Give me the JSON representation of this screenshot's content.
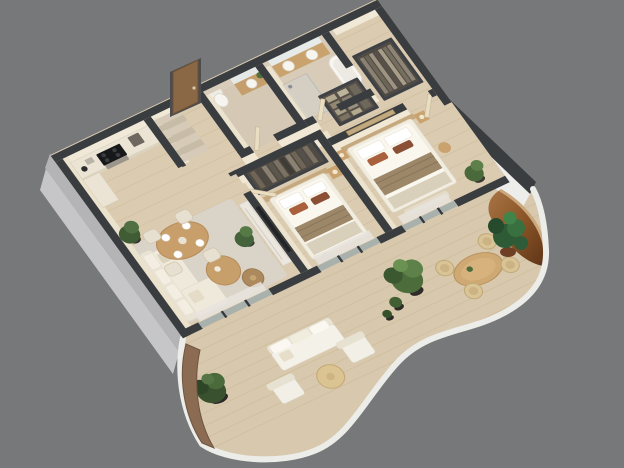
{
  "meta": {
    "description": "Photorealistic 3D isometric cutaway floor-plan render of a furnished one-level apartment, viewed from above at a rotated angle, on a plain gray studio background",
    "view": "axonometric dollhouse cutaway, walls sliced flat with dark tops",
    "no_visible_text": true
  },
  "colors": {
    "background": "#77787a",
    "wall_top": "#3a3d40",
    "exterior_wall": "#c6c6c8",
    "interior_wall": "#f0e9d7",
    "interior_wall_shade": "#ece3cf",
    "floor_wood": "#dbcbb0",
    "plank_line": "#c9b693",
    "tile": "#d5c8b4",
    "rug": "#dad3c7",
    "wood_furniture": "#c89f6a",
    "cream_fabric": "#efe9db",
    "bedding": "#faf7ef",
    "bed_runner": "#9d8769",
    "accent_pillow": "#a9613d",
    "wardrobe_frame": "#3e4145",
    "foliage": "#4c6c3b",
    "foliage_dark": "#2f4b2a",
    "balcony_floor": "#d8c9ae",
    "balcony_rim": "#ecece9",
    "copper_wall": "#9c6840",
    "planter_bronze": "#8b6c52",
    "glass": "#cfd8d6",
    "curtain": "#e7e4de",
    "door_wood": "#8a6845",
    "marble_console": "#ebe7df"
  },
  "apartment": {
    "rooms": [
      {
        "name": "kitchen",
        "position": "top-left corner",
        "furniture": [
          "straight counter with black cooktop and oven under",
          "side counter return with kettle and small appliances",
          "coffee machine"
        ]
      },
      {
        "name": "staircase",
        "position": "beside kitchen",
        "furniture": [
          "narrow stair run with seven treads"
        ]
      },
      {
        "name": "hallway",
        "position": "center-left",
        "furniture": [
          "wood entry door on the upper exterior wall"
        ]
      },
      {
        "name": "guest-bathroom",
        "position": "top-center",
        "furniture": [
          "toilet",
          "wood vanity with round basin",
          "lit mirror",
          "small plant"
        ]
      },
      {
        "name": "master-bathroom",
        "position": "top-right",
        "furniture": [
          "double wood vanity with two round basins",
          "wide lit mirror",
          "freestanding bathtub",
          "glass walk-in shower",
          "travertine tiled walls"
        ]
      },
      {
        "name": "walk-in-closet",
        "position": "right of center",
        "furniture": [
          "open wardrobe with folded clothes on shelves",
          "open wardrobe with hanging clothes"
        ]
      },
      {
        "name": "bedroom",
        "position": "center",
        "furniture": [
          "double bed with white bedding, beige runner and rust pillows",
          "wood headboard",
          "nightstand with lamp",
          "open wardrobe with hanging clothes",
          "round pouf"
        ]
      },
      {
        "name": "master-bedroom",
        "position": "right",
        "furniture": [
          "double bed with white bedding, striped runner and rust pillows",
          "two nightstands with lamps",
          "wall art above headboard",
          "bench at bed foot",
          "round side table",
          "corner plant"
        ]
      },
      {
        "name": "living-room",
        "position": "bottom-left",
        "furniture": [
          "L-shaped cream sectional sofa with cushions",
          "two round wood nesting coffee tables",
          "large beige area rug",
          "marble media console with TV on partition wall",
          "floor plant"
        ]
      },
      {
        "name": "dining-area",
        "position": "left",
        "furniture": [
          "round wood dining table set for four with plates",
          "four cream upholstered chairs",
          "corner floor plant"
        ]
      }
    ],
    "facade": {
      "type": "floor-to-ceiling glazing",
      "elements": [
        "dark framed sliding doors",
        "sheer curtains",
        "three glazed bays: living room, bedroom, master bedroom"
      ]
    },
    "balcony": {
      "shape": "organic wavy terrace wrapping the lower facade from left corner to right corner",
      "features": [
        "white rounded parapet rim",
        "curved bronze planter wall with dark green bush at left tip",
        "outdoor cream sofa",
        "two outdoor lounge chairs",
        "round outdoor coffee table",
        "potted tree and small planters outside bedroom",
        "oval wood outdoor dining table",
        "four wicker chairs",
        "copper arched niche with tropical monstera plants at right"
      ]
    }
  }
}
